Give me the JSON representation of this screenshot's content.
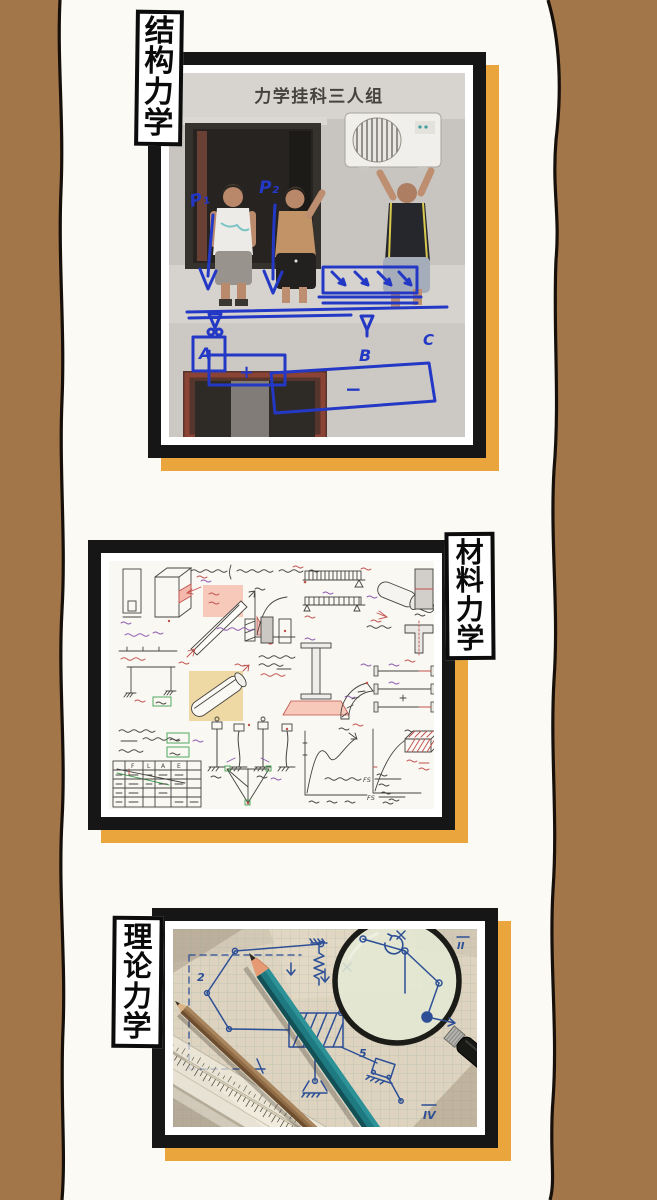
{
  "colors": {
    "side_panel_brown": "#a3764a",
    "torn_edge_black": "#17100a",
    "page_white": "#fbfaf5",
    "frame_black": "#161616",
    "shadow_orange": "#eaa53d",
    "marker_blue": "#2438c6",
    "ink_blue": "#2d4f96",
    "pencil_teal": "#1e7a80"
  },
  "sections": [
    {
      "name": "structural-mechanics",
      "label": "结构力学",
      "label_chars": [
        "结",
        "构",
        "力",
        "学"
      ],
      "photo": {
        "alt": "Three men on a window ledge installing an air conditioner, overdrawn with blue marker beam and moment diagrams",
        "caption": "力学挂科三人组",
        "force_labels": [
          "P₁",
          "P₂"
        ],
        "support_labels": [
          "A",
          "B"
        ],
        "end_label": "C",
        "moment_signs": [
          "+",
          "+",
          "−"
        ]
      }
    },
    {
      "name": "materials-mechanics",
      "label": "材料力学",
      "label_chars": [
        "材",
        "料",
        "力",
        "学"
      ],
      "notes": {
        "alt": "Dense handwritten mechanics-of-materials study notes with beams, shafts, stress-strain curves, truss and tables",
        "table_headers": [
          "F",
          "L",
          "A",
          "E"
        ],
        "fs_label": "FS",
        "legible_notes": [
          "Strain Energy",
          "Factor of safety = FS = ultimate load / allowable load",
          "FS = ultimate stress / allowable stress"
        ]
      }
    },
    {
      "name": "theoretical-mechanics",
      "label": "理论力学",
      "label_chars": [
        "理",
        "论",
        "力",
        "学"
      ],
      "photo": {
        "alt": "Pencils, rulers and a magnifying glass over hand-drawn linkage mechanism sketches on graph paper",
        "sketch_labels": [
          "2",
          "3",
          "5",
          "II",
          "IV"
        ]
      }
    }
  ]
}
